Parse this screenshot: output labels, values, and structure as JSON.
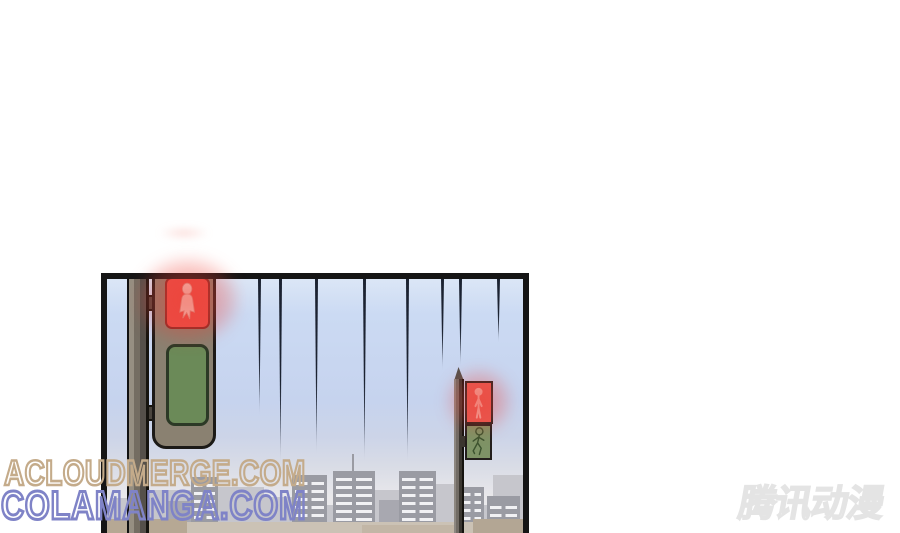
{
  "watermarks": {
    "line1": {
      "text": "ACLOUDMERGE.COM",
      "color": "#c4ab8a"
    },
    "line2": {
      "text": "COLAMANGA.COM",
      "color": "#7f83c7"
    }
  },
  "logo": {
    "text": "腾讯动漫",
    "color": "#e4e4e4"
  },
  "panel": {
    "border_color": "#151515",
    "sky_top_color": "#dbe6f6",
    "sky_mid_color": "#c6d3ee",
    "sky_bottom_color": "#f2f0f0",
    "speed_line_color": "#1b2231",
    "traffic_light_left": {
      "box_color": "#8a8171",
      "pole_color": "#746d62",
      "red_color": "#eb4f48",
      "green_color": "#6b8a58",
      "icon_color": "#f6d6cc"
    },
    "traffic_light_right": {
      "pole_color": "#716b64",
      "red_color": "#e85b53",
      "green_color": "#7e9366",
      "red_icon_color": "#f3b2a8",
      "green_icon_color": "#3c532f"
    },
    "glow_color": "#ee3e34",
    "buildings": {
      "background_color": "#c6c6cc",
      "midground_color": "#a8a8b0",
      "foreground_color": "#9a9ba3",
      "window_color": "#f1f1f4",
      "street_color": "#cbc2b5"
    },
    "speed_lines": [
      {
        "x": 151,
        "len": 137
      },
      {
        "x": 172,
        "len": 186
      },
      {
        "x": 208,
        "len": 176
      },
      {
        "x": 256,
        "len": 184
      },
      {
        "x": 299,
        "len": 184
      },
      {
        "x": 334,
        "len": 92
      },
      {
        "x": 352,
        "len": 88
      },
      {
        "x": 390,
        "len": 64
      }
    ],
    "bg_buildings": [
      {
        "x": 3,
        "top": 219,
        "w": 42
      },
      {
        "x": 43,
        "top": 211,
        "w": 44
      },
      {
        "x": 109,
        "top": 208,
        "w": 48
      },
      {
        "x": 151,
        "top": 218,
        "w": 34
      },
      {
        "x": 266,
        "top": 211,
        "w": 30
      },
      {
        "x": 327,
        "top": 205,
        "w": 30
      },
      {
        "x": 386,
        "top": 196,
        "w": 30
      },
      {
        "x": 0,
        "top": 226,
        "w": 416
      }
    ],
    "mid_buildings": [
      {
        "x": 60,
        "top": 222,
        "w": 28
      },
      {
        "x": 272,
        "top": 221,
        "w": 30
      }
    ],
    "fg_buildings": [
      {
        "x": 84,
        "top": 198,
        "w": 27,
        "win_top": 7,
        "antenna": -1
      },
      {
        "x": 185,
        "top": 196,
        "w": 35,
        "win_top": 7,
        "antenna": -1
      },
      {
        "x": 226,
        "top": 192,
        "w": 42,
        "win_top": 7,
        "antenna": 19
      },
      {
        "x": 292,
        "top": 192,
        "w": 37,
        "win_top": 7,
        "antenna": -1
      },
      {
        "x": 354,
        "top": 208,
        "w": 23,
        "win_top": 6,
        "antenna": -1
      },
      {
        "x": 380,
        "top": 217,
        "w": 33,
        "win_top": 10,
        "antenna": -1
      }
    ],
    "street_blocks": [
      {
        "x": 0,
        "top": 243,
        "w": 416,
        "color": "#cbc2b5"
      },
      {
        "x": 0,
        "top": 240,
        "w": 80,
        "color": "#b6a894"
      },
      {
        "x": 255,
        "top": 246,
        "w": 95,
        "color": "#c2b6a6"
      },
      {
        "x": 366,
        "top": 240,
        "w": 50,
        "color": "#b3a694"
      }
    ]
  }
}
